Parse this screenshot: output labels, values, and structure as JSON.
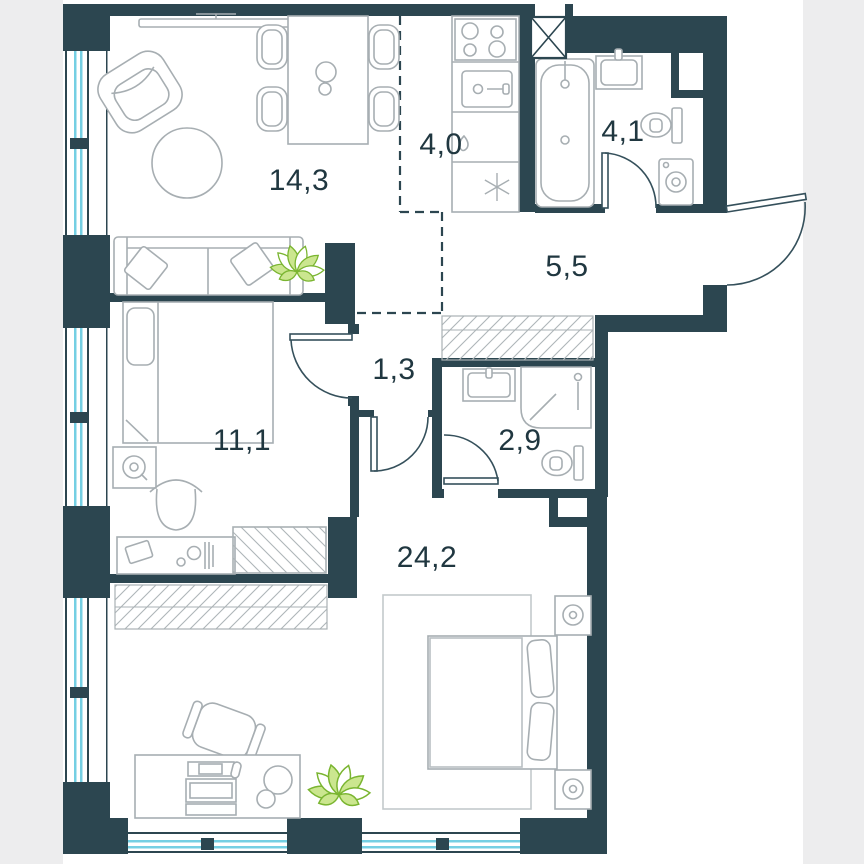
{
  "plan": {
    "title": "apartment-floor-plan",
    "rooms": [
      {
        "id": "living-dining",
        "label": "14,3"
      },
      {
        "id": "kitchen",
        "label": "4,0"
      },
      {
        "id": "bathroom-main",
        "label": "4,1"
      },
      {
        "id": "entrance-hall",
        "label": "5,5"
      },
      {
        "id": "inner-hall",
        "label": "1,3"
      },
      {
        "id": "bedroom-small",
        "label": "11,1"
      },
      {
        "id": "bathroom-second",
        "label": "2,9"
      },
      {
        "id": "bedroom-master",
        "label": "24,2"
      }
    ],
    "colors": {
      "wall": "#2c4650",
      "window_glass": "#74cfe3",
      "furniture_line": "#a7aeb2",
      "plant_green": "#7ab530",
      "label_text": "#203740",
      "page_margin": "#ededee",
      "floor": "#ffffff"
    }
  }
}
